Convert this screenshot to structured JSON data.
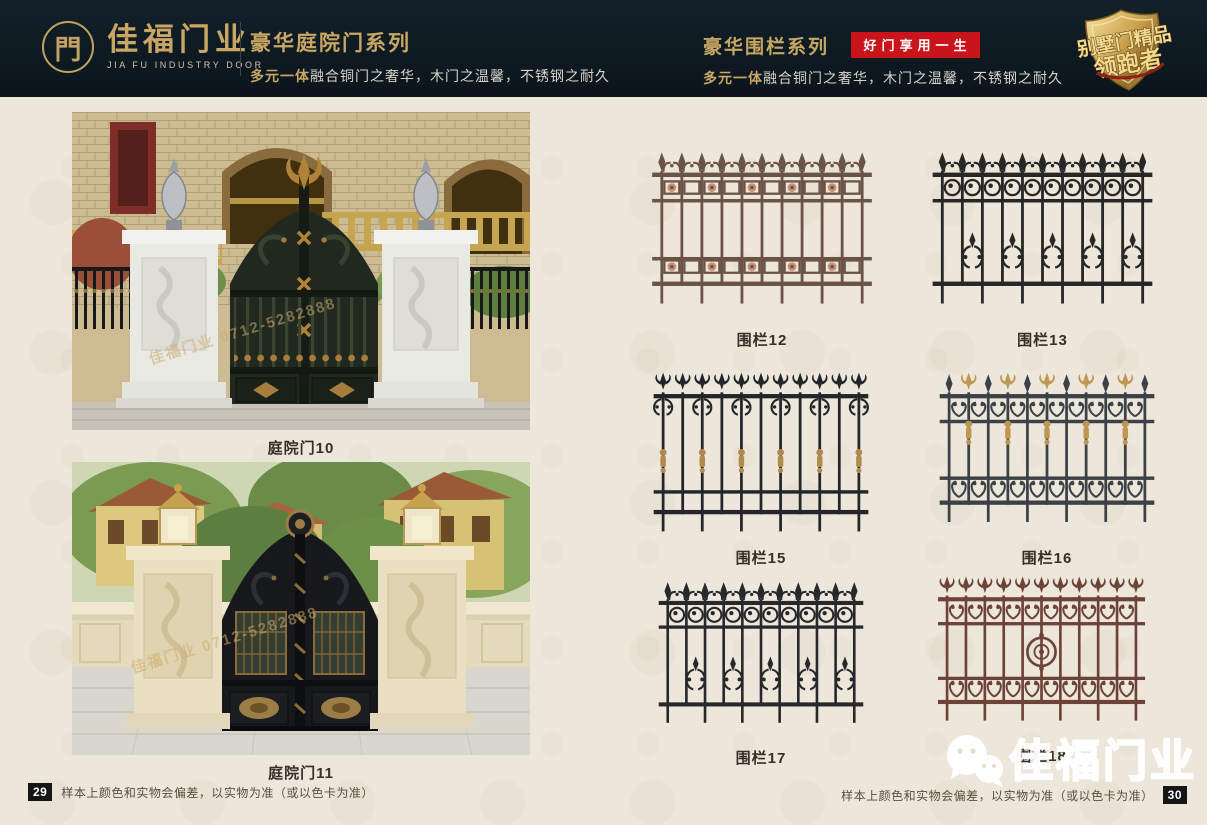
{
  "header": {
    "logo": {
      "glyph": "門",
      "name_cn": "佳福门业",
      "name_en": "JIA FU INDUSTRY DOOR"
    },
    "left_series": {
      "title": "豪华庭院门系列",
      "subtitle_em": "多元一体",
      "subtitle_rest": "融合铜门之奢华，木门之温馨，不锈钢之耐久"
    },
    "right_series": {
      "title": "豪华围栏系列",
      "badge": "好门享用一生",
      "subtitle_em": "多元一体",
      "subtitle_rest": "融合铜门之奢华，木门之温馨，不锈钢之耐久"
    },
    "shield_badge": {
      "line1": "别墅门精品",
      "line2": "领跑者"
    },
    "colors": {
      "header_bg": "#0d1820",
      "gold": "#c9a664",
      "red_badge": "#c8141a"
    }
  },
  "photos": [
    {
      "caption": "庭院门10",
      "watermark": "佳福门业 0712-5282888"
    },
    {
      "caption": "庭院门11",
      "watermark": "佳福门业 0712-5282888"
    }
  ],
  "fences": [
    {
      "label": "围栏12",
      "color": "#6b5347",
      "accent": "#c99078",
      "finial": "spear-scroll",
      "top_band": "frames",
      "under": "none",
      "mid": "none",
      "bottom": "frames"
    },
    {
      "label": "围栏13",
      "color": "#272727",
      "accent": "#272727",
      "finial": "spear-scroll",
      "top_band": "rings",
      "under": "none",
      "mid": "cluster",
      "bottom": "rail"
    },
    {
      "label": "围栏15",
      "color": "#22262a",
      "accent": "#b08a4e",
      "finial": "fleur",
      "top_band": "none",
      "under": "scrolls",
      "mid": "collars",
      "bottom": "double"
    },
    {
      "label": "围栏16",
      "color": "#3b4147",
      "accent": "#bf9752",
      "finial": "alt",
      "top_band": "hearts",
      "under": "none",
      "mid": "collars-high",
      "bottom": "hearts"
    },
    {
      "label": "围栏17",
      "color": "#26282b",
      "accent": "#6d5a3e",
      "finial": "spear-scroll",
      "top_band": "rings",
      "under": "none",
      "mid": "cluster",
      "bottom": "rail"
    },
    {
      "label": "围栏18",
      "color": "#6d4339",
      "accent": "#8a564a",
      "finial": "fleur",
      "top_band": "hearts",
      "under": "none",
      "mid": "medallion",
      "bottom": "hearts"
    }
  ],
  "footer": {
    "left_page": "29",
    "right_page": "30",
    "disclaimer": "样本上颜色和实物会偏差，以实物为准（或以色卡为准）"
  },
  "watermark": {
    "brand": "佳福门业",
    "icon": "wechat-icon"
  },
  "page_bg": "#ece7da"
}
